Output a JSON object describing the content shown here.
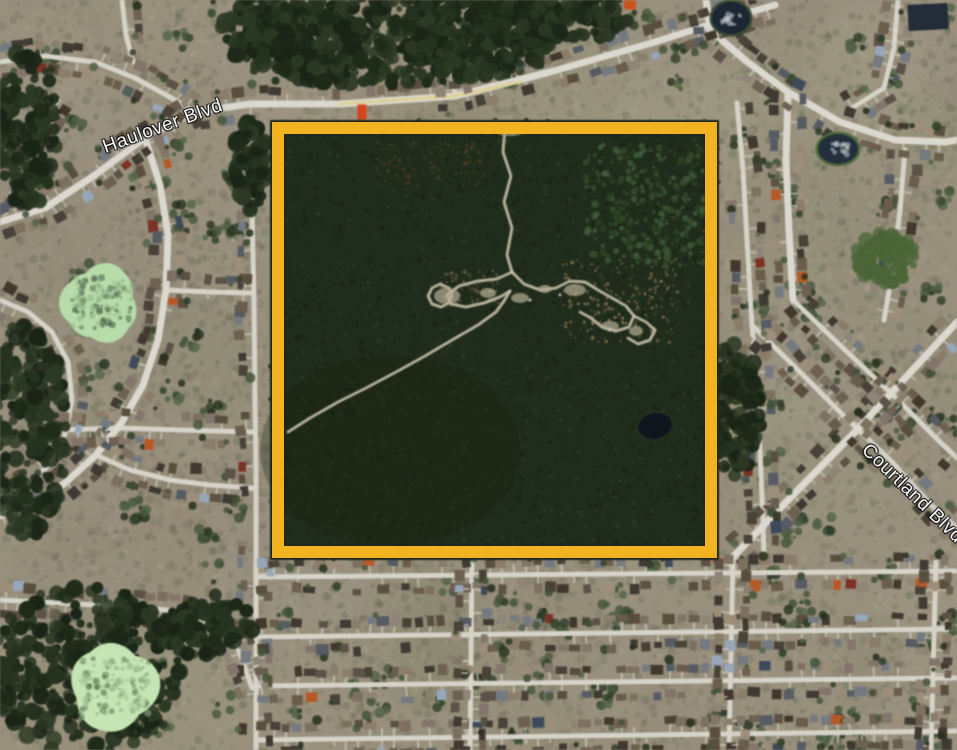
{
  "map": {
    "description": "Satellite aerial view of a suburban neighborhood with a forested undeveloped parcel outlined by a gold rectangle",
    "street_labels": [
      {
        "id": "haulover",
        "text": "Haulover Blvd",
        "x": 163,
        "y": 127,
        "rotation": -20
      },
      {
        "id": "courtland",
        "text": "Courtland Blvd",
        "x": 912,
        "y": 494,
        "rotation": 44
      }
    ],
    "highlight_rectangle": {
      "x": 272,
      "y": 122,
      "width": 445,
      "height": 436,
      "border_width": 12,
      "color": "#F1B31F"
    },
    "palette": {
      "ground": "#98907e",
      "road": "#dbd8cf",
      "road_minor": "#d6d3c9",
      "road_center_tint": "#e0cd6e",
      "forest_dark": "#1e2a1b",
      "parcel_base": "#202c1c",
      "trail": "#cbc5b0",
      "pond_light_green": "#b9dcab",
      "pond_pale_green": "#c6e5b6",
      "pond_dark_water": "#242f3d",
      "label_text": "#ffffff"
    },
    "roads_main": [
      [
        0,
        222,
        45,
        208,
        95,
        175,
        145,
        138,
        195,
        112,
        250,
        104,
        340,
        104,
        455,
        96,
        550,
        72,
        655,
        42,
        740,
        15,
        775,
        5
      ],
      [
        706,
        0,
        710,
        30,
        745,
        60,
        788,
        92
      ],
      [
        788,
        92,
        786,
        160,
        789,
        230,
        793,
        300
      ],
      [
        788,
        92,
        840,
        122,
        895,
        140,
        945,
        142,
        957,
        140
      ],
      [
        730,
        560,
        790,
        498,
        855,
        432,
        920,
        362,
        957,
        322
      ],
      [
        145,
        138,
        160,
        185,
        168,
        235,
        166,
        290,
        158,
        340,
        143,
        385,
        122,
        422,
        96,
        455,
        65,
        483,
        35,
        503,
        0,
        516
      ]
    ],
    "roads_minor": [
      [
        0,
        62,
        45,
        56,
        95,
        62,
        135,
        78,
        168,
        96,
        195,
        112
      ],
      [
        122,
        0,
        126,
        35,
        133,
        62
      ],
      [
        58,
        100,
        35,
        135,
        18,
        175,
        6,
        212
      ],
      [
        0,
        300,
        28,
        312,
        52,
        332,
        68,
        362,
        72,
        400,
        64,
        438,
        46,
        468,
        22,
        488,
        0,
        498
      ],
      [
        252,
        208,
        254,
        300,
        255,
        400,
        256,
        470,
        256,
        750
      ],
      [
        60,
        430,
        120,
        428,
        180,
        430,
        252,
        432
      ],
      [
        0,
        600,
        60,
        603,
        130,
        607,
        190,
        612,
        235,
        640,
        252,
        688
      ],
      [
        256,
        577,
        957,
        571
      ],
      [
        256,
        637,
        957,
        629
      ],
      [
        256,
        686,
        957,
        678
      ],
      [
        256,
        740,
        957,
        731
      ],
      [
        472,
        559,
        470,
        750
      ],
      [
        733,
        559,
        729,
        750
      ],
      [
        936,
        560,
        931,
        750
      ],
      [
        753,
        326,
        800,
        372,
        846,
        418,
        892,
        462,
        932,
        506,
        957,
        528
      ],
      [
        793,
        300,
        843,
        348,
        893,
        395,
        938,
        440,
        957,
        458
      ],
      [
        737,
        103,
        743,
        170,
        747,
        240,
        751,
        310,
        756,
        380,
        760,
        450,
        763,
        520,
        764,
        558
      ],
      [
        898,
        0,
        894,
        48,
        884,
        88,
        852,
        108
      ],
      [
        905,
        150,
        900,
        210,
        893,
        268,
        884,
        320
      ],
      [
        455,
        96,
        451,
        55,
        449,
        20,
        448,
        0
      ],
      [
        166,
        290,
        210,
        292,
        252,
        293
      ],
      [
        96,
        455,
        130,
        470,
        170,
        480,
        210,
        485,
        252,
        488
      ]
    ],
    "road_tint_segment": [
      340,
      104,
      455,
      96,
      520,
      82
    ],
    "parcel_trails": [
      [
        505,
        128,
        503,
        152,
        511,
        176,
        504,
        202,
        512,
        228,
        507,
        255,
        512,
        272
      ],
      [
        512,
        272,
        524,
        284,
        540,
        290,
        556,
        288,
        570,
        281,
        585,
        282,
        598,
        290,
        612,
        298,
        626,
        306,
        634,
        316,
        629,
        327,
        616,
        331,
        602,
        327,
        591,
        318,
        580,
        312
      ],
      [
        512,
        272,
        497,
        279,
        478,
        281,
        459,
        286,
        447,
        295,
        451,
        304,
        466,
        307,
        484,
        303,
        500,
        297,
        510,
        291
      ],
      [
        510,
        291,
        504,
        301,
        496,
        312,
        478,
        325,
        452,
        340,
        425,
        356,
        396,
        372,
        366,
        388,
        338,
        402,
        310,
        418,
        288,
        432
      ],
      [
        634,
        316,
        646,
        322,
        655,
        330,
        650,
        340,
        638,
        344,
        628,
        338
      ],
      [
        449,
        288,
        440,
        284,
        432,
        288,
        428,
        296,
        432,
        304,
        441,
        307,
        449,
        303,
        452,
        295,
        449,
        288
      ]
    ],
    "parcel_clearings": [
      [
        447,
        296,
        13,
        8
      ],
      [
        520,
        298,
        9,
        5
      ],
      [
        575,
        290,
        11,
        6
      ],
      [
        610,
        326,
        9,
        5
      ],
      [
        636,
        331,
        7,
        5
      ],
      [
        545,
        289,
        7,
        4
      ],
      [
        510,
        132,
        13,
        4
      ],
      [
        488,
        293,
        8,
        5
      ]
    ],
    "forest_regions": [
      {
        "cx": 390,
        "cy": 25,
        "rx": 170,
        "ry": 60,
        "n": 500
      },
      {
        "cx": 300,
        "cy": 45,
        "rx": 70,
        "ry": 40,
        "n": 160
      },
      {
        "cx": 480,
        "cy": 35,
        "rx": 80,
        "ry": 42,
        "n": 170
      },
      {
        "cx": 575,
        "cy": 15,
        "rx": 60,
        "ry": 25,
        "n": 120
      },
      {
        "cx": 25,
        "cy": 430,
        "rx": 42,
        "ry": 110,
        "n": 230
      },
      {
        "cx": 85,
        "cy": 670,
        "rx": 95,
        "ry": 85,
        "n": 330
      },
      {
        "cx": 735,
        "cy": 410,
        "rx": 26,
        "ry": 68,
        "n": 130
      },
      {
        "cx": 205,
        "cy": 625,
        "rx": 48,
        "ry": 32,
        "n": 110
      },
      {
        "cx": 25,
        "cy": 130,
        "rx": 32,
        "ry": 80,
        "n": 150
      },
      {
        "cx": 250,
        "cy": 165,
        "rx": 16,
        "ry": 45,
        "n": 80
      }
    ],
    "ponds_light": [
      {
        "cx": 102,
        "cy": 303,
        "rx": 40,
        "ry": 34,
        "color": "#b9dcab",
        "mottle": "#88a87c",
        "dark": "#3a4a3a"
      },
      {
        "cx": 114,
        "cy": 688,
        "rx": 46,
        "ry": 40,
        "color": "#c6e5b6",
        "mottle": "#93b283",
        "dark": "#57704f"
      }
    ],
    "ponds_dark": [
      {
        "cx": 838,
        "cy": 149,
        "rx": 20,
        "ry": 15,
        "color": "#242f3d",
        "rim": "#4e6b3e",
        "hl": "#cdd3d8"
      },
      {
        "cx": 731,
        "cy": 18,
        "rx": 19,
        "ry": 16,
        "color": "#1c2633",
        "rim": "#3c4c34",
        "hl": "#c8cdd4"
      }
    ],
    "parcel_pond": {
      "cx": 655,
      "cy": 426,
      "rx": 17,
      "ry": 13,
      "color": "#10151e",
      "rim": "#26331f"
    },
    "green_field": {
      "cx": 886,
      "cy": 258,
      "rx": 30,
      "ry": 26,
      "color": "#4c6638"
    },
    "special_buildings": [
      {
        "x": 362,
        "y": 112,
        "w": 9,
        "h": 15,
        "color": "#d2441e",
        "rot": 0
      },
      {
        "x": 630,
        "y": 5,
        "w": 12,
        "h": 9,
        "color": "#c8551e",
        "rot": 0.1
      },
      {
        "x": 928,
        "y": 17,
        "w": 40,
        "h": 26,
        "color": "#232c38",
        "rot": -0.05
      }
    ]
  }
}
